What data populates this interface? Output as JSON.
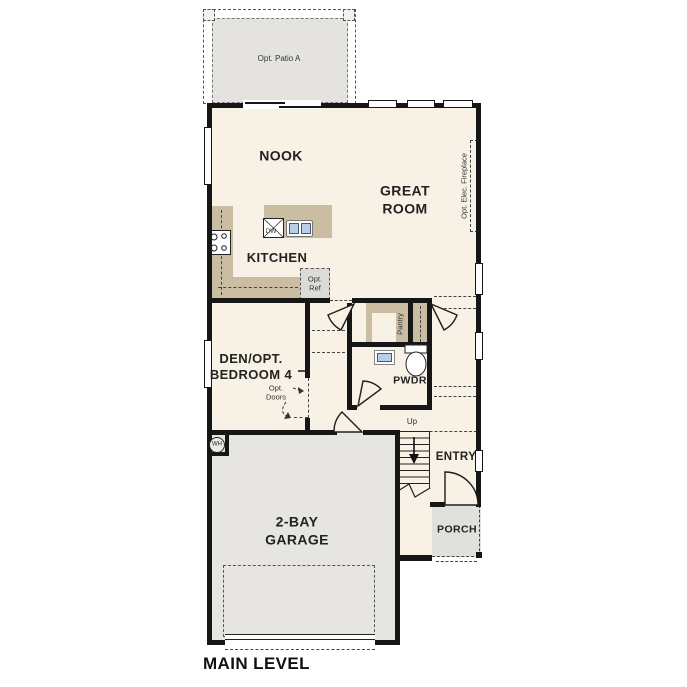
{
  "plan": {
    "title": "MAIN LEVEL",
    "rooms": {
      "nook": "NOOK",
      "great_room": "GREAT\nROOM",
      "kitchen": "KITCHEN",
      "den": "DEN/OPT.\nBEDROOM 4",
      "pwdr": "PWDR",
      "entry": "ENTRY",
      "porch": "PORCH",
      "garage": "2-BAY\nGARAGE",
      "pantry": "Pantry"
    },
    "annotations": {
      "patio": "Opt. Patio A",
      "fireplace": "Opt. Elec. Fireplace",
      "ref": "Opt.\nRef",
      "opt_doors": "Opt.\nDoors",
      "dishwasher": "DW",
      "water_heater": "WH",
      "up": "Up"
    },
    "colors": {
      "floor": "#f8f1e5",
      "garage_gray": "#e6e5e2",
      "patio_gray": "#e4e3e0",
      "porch_gray": "#e1e0dd",
      "counter_tan": "#cabda2",
      "fixture_blue": "#b9cfe7",
      "wall_black": "#161616"
    }
  }
}
